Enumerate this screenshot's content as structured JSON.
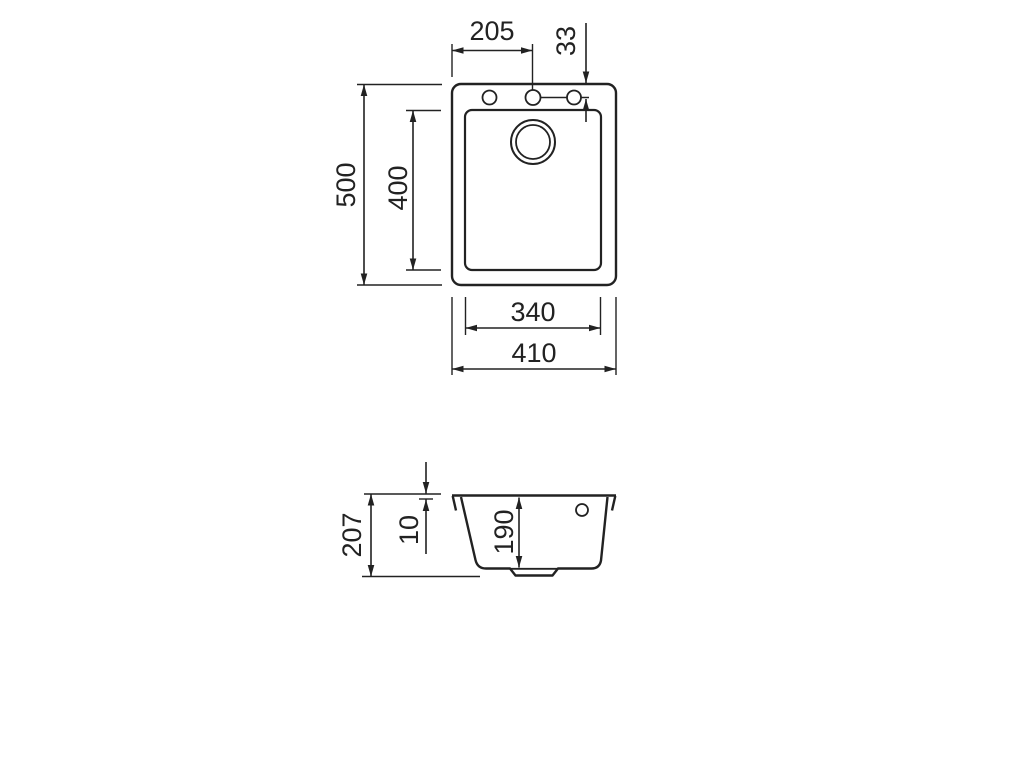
{
  "colors": {
    "background": "#ffffff",
    "line": "#222222"
  },
  "views": {
    "top": {
      "label": "sink top view",
      "features": {
        "faucet_hole_count": 3,
        "drain": "double circle",
        "bowl": "rounded rectangle"
      },
      "dims": {
        "hole_center_x": "205",
        "hole_offset_y": "33",
        "overall_depth": "500",
        "bowl_depth": "400",
        "bowl_width": "340",
        "overall_width": "410"
      }
    },
    "section": {
      "label": "sink section view",
      "features": {
        "faucet_hole_count": 1,
        "drain": "recessed sump"
      },
      "dims": {
        "overall_height": "207",
        "rim_height": "10",
        "bowl_depth": "190"
      }
    }
  }
}
